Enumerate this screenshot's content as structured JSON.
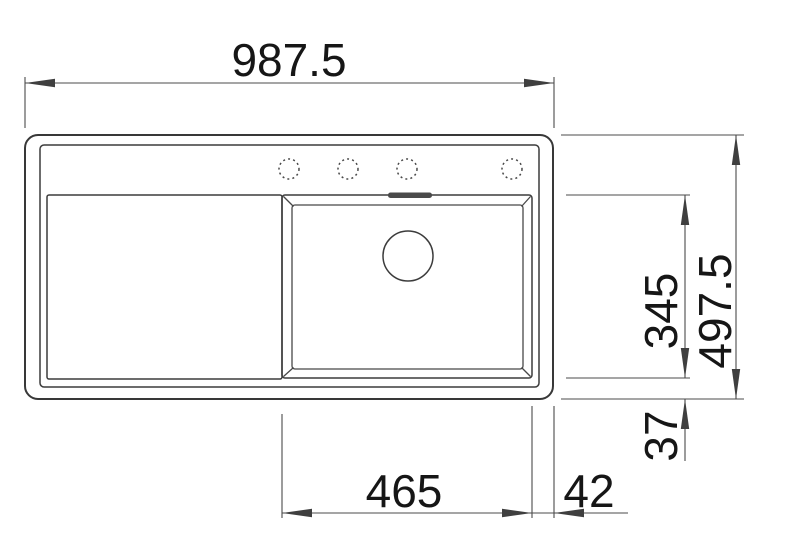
{
  "drawing": {
    "kind": "sink-plan-technical-drawing",
    "colors": {
      "background": "#ffffff",
      "object_line": "#3c3c3c",
      "dimension_line": "#4b4b4b",
      "text": "#161616",
      "overflow_slot_fill": "#4a4a4a"
    },
    "features": {
      "faucet_hole_count": 4,
      "drain_count": 1,
      "overflow_slot_count": 1
    },
    "dimensions": {
      "overall_width": "987.5",
      "overall_depth": "497.5",
      "bowl_depth": "345",
      "bottom_rim_offset": "37",
      "bowl_width": "465",
      "side_rim_offset": "42"
    }
  }
}
